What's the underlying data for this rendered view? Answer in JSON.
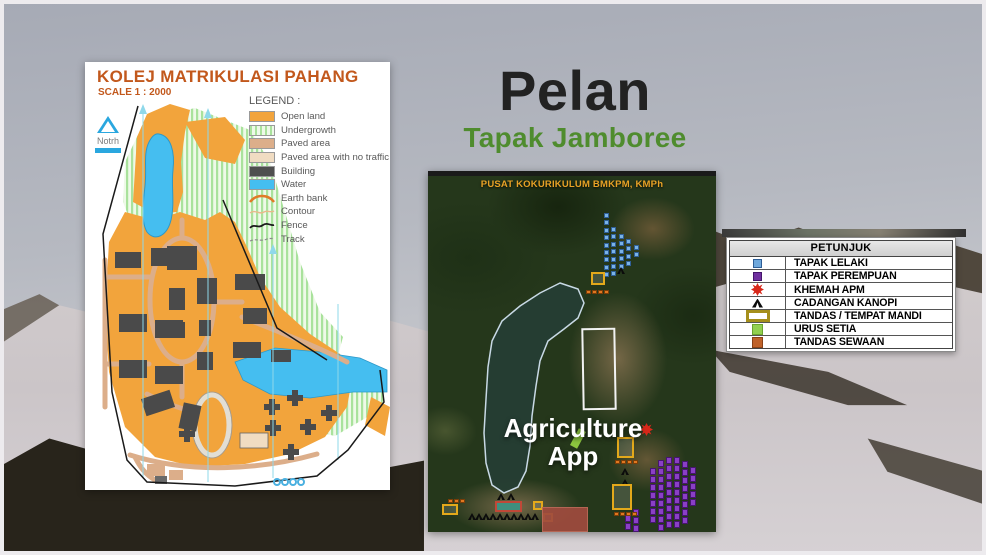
{
  "slide": {
    "title": "Pelan",
    "subtitle": "Tapak Jamboree"
  },
  "left_map": {
    "title": "KOLEJ MATRIKULASI PAHANG",
    "scale_label": "SCALE 1 : 2000",
    "north_label": "Notrh",
    "legend_title": "LEGEND :",
    "legend_items": [
      {
        "label": "Open land",
        "type": "swatch",
        "color": "#F2A43C"
      },
      {
        "label": "Undergrowth",
        "type": "stripes",
        "color": "#A9E29C"
      },
      {
        "label": "Paved area",
        "type": "swatch",
        "color": "#DCAE8A"
      },
      {
        "label": "Paved area with no traffic",
        "type": "swatch",
        "color": "#F0DCC2"
      },
      {
        "label": "Building",
        "type": "swatch",
        "color": "#4F4F4F"
      },
      {
        "label": "Water",
        "type": "swatch",
        "color": "#45BEF0"
      },
      {
        "label": "Earth bank",
        "type": "line-earth",
        "color": "#E07B28"
      },
      {
        "label": "Contour",
        "type": "line-contour",
        "color": "#E8B98C"
      },
      {
        "label": "Fence",
        "type": "line-fence",
        "color": "#1A1A1A"
      },
      {
        "label": "Track",
        "type": "line-track",
        "color": "#8A8A8A"
      }
    ]
  },
  "satellite_map": {
    "title": "PUSAT KOKURIKULUM BMKPM, KMPh",
    "title_color": "#E8A226",
    "overlay_line1": "Agriculture",
    "overlay_line2": "App"
  },
  "petunjuk": {
    "title": "PETUNJUK",
    "items": [
      {
        "label": "TAPAK LELAKI",
        "icon": "blue-square",
        "color": "#6FA8DC"
      },
      {
        "label": "TAPAK PEREMPUAN",
        "icon": "purple-square",
        "color": "#7030A0"
      },
      {
        "label": "KHEMAH APM",
        "icon": "red-star",
        "color": "#D8281A"
      },
      {
        "label": "CADANGAN KANOPI",
        "icon": "black-canopy-triangle",
        "color": "#0B0B0B"
      },
      {
        "label": "TANDAS / TEMPAT MANDI",
        "icon": "yellow-outline-rect",
        "color": "#A58F1C"
      },
      {
        "label": "URUS SETIA",
        "icon": "green-square",
        "color": "#92D050"
      },
      {
        "label": "TANDAS SEWAAN",
        "icon": "brown-square",
        "color": "#C0622A"
      }
    ]
  },
  "sat_markers": {
    "blue_step": 7.4,
    "blue_columns": [
      {
        "x": 176,
        "y": 42,
        "n": 9
      },
      {
        "x": 183,
        "y": 56,
        "n": 7
      },
      {
        "x": 191,
        "y": 63,
        "n": 5
      },
      {
        "x": 198,
        "y": 68,
        "n": 4
      },
      {
        "x": 206,
        "y": 74,
        "n": 2
      }
    ],
    "purple_step": 8,
    "purple_columns": [
      {
        "x": 222,
        "y": 297,
        "n": 7
      },
      {
        "x": 230,
        "y": 289,
        "n": 9
      },
      {
        "x": 238,
        "y": 286,
        "n": 9
      },
      {
        "x": 246,
        "y": 286,
        "n": 9
      },
      {
        "x": 254,
        "y": 290,
        "n": 8
      },
      {
        "x": 262,
        "y": 296,
        "n": 5
      },
      {
        "x": 197,
        "y": 344,
        "n": 2
      },
      {
        "x": 205,
        "y": 338,
        "n": 3
      }
    ],
    "orange_step": 6,
    "orange_rows": [
      {
        "x": 158,
        "y": 119,
        "n": 4
      },
      {
        "x": 187,
        "y": 289,
        "n": 4
      },
      {
        "x": 186,
        "y": 341,
        "n": 4
      },
      {
        "x": 20,
        "y": 328,
        "n": 3
      }
    ],
    "triangles": [
      [
        189,
        96
      ],
      [
        69,
        322
      ],
      [
        79,
        322
      ],
      [
        193,
        297
      ],
      [
        193,
        308
      ]
    ],
    "triangle_row": {
      "x": 40,
      "y": 342,
      "n": 10,
      "step": 7
    },
    "yellow_rects": [
      {
        "x": 163,
        "y": 101,
        "w": 14,
        "h": 13
      },
      {
        "x": 189,
        "y": 266,
        "w": 17,
        "h": 21
      },
      {
        "x": 184,
        "y": 313,
        "w": 20,
        "h": 26
      },
      {
        "x": 14,
        "y": 333,
        "w": 16,
        "h": 11
      },
      {
        "x": 105,
        "y": 330,
        "w": 10,
        "h": 9
      },
      {
        "x": 115,
        "y": 342,
        "w": 10,
        "h": 9
      }
    ],
    "red_marker": {
      "x": 212,
      "y": 252
    },
    "green_area": {
      "x": 146,
      "y": 258
    },
    "white_rect": {
      "x": 154,
      "y": 157,
      "w": 34,
      "h": 82
    },
    "pool": {
      "x": 67,
      "y": 330,
      "w": 27,
      "h": 11
    },
    "court": {
      "x": 114,
      "y": 336,
      "w": 46,
      "h": 25
    }
  }
}
